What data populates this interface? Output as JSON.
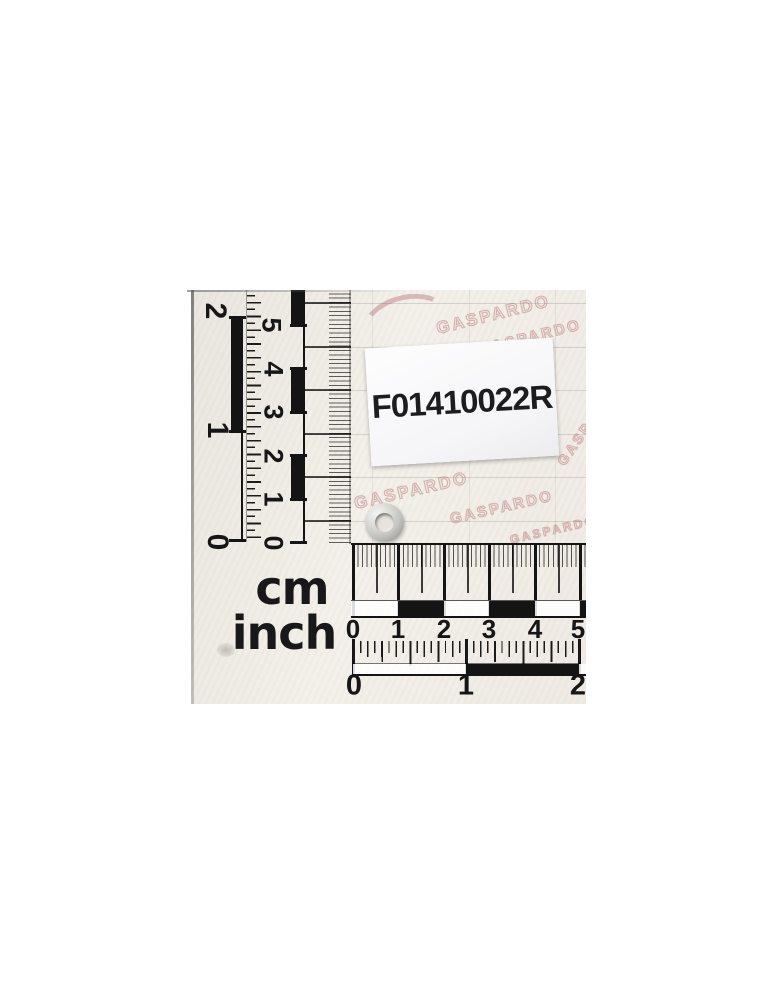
{
  "sticker": {
    "part_number": "F01410022R"
  },
  "units": {
    "cm": "cm",
    "inch": "inch"
  },
  "scales": {
    "vertical_inch": [
      "0",
      "1",
      "2"
    ],
    "vertical_cm": [
      "0",
      "1",
      "2",
      "3",
      "4",
      "5"
    ],
    "horizontal_cm": [
      "0",
      "1",
      "2",
      "3",
      "4",
      "5"
    ],
    "horizontal_inch": [
      "0",
      "1",
      "2"
    ]
  },
  "watermark": {
    "brand": "GASPARDO"
  },
  "colors": {
    "page": "#ffffff",
    "paper": "#efece5",
    "ink": "#141414",
    "watermark_pink": "#be8484",
    "sticker_bg": "#fbfbfd",
    "washer_silver": "#c9c9c6"
  }
}
